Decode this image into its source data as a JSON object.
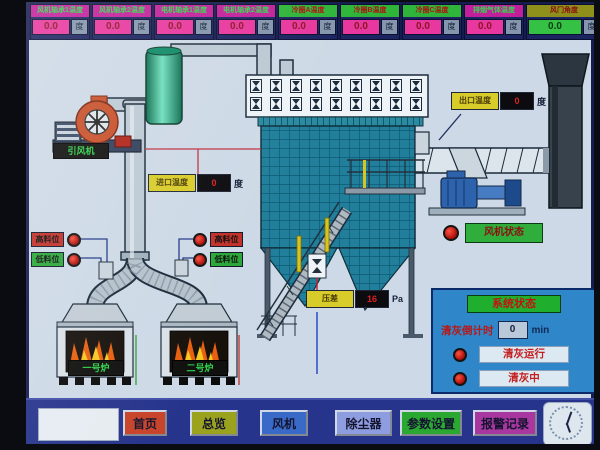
{
  "top_gauges": [
    {
      "label": "风机轴承1温度",
      "value": "0.0",
      "unit": "度",
      "style": "magenta"
    },
    {
      "label": "风机轴承2温度",
      "value": "0.0",
      "unit": "度",
      "style": "magenta"
    },
    {
      "label": "电机轴承1温度",
      "value": "0.0",
      "unit": "度",
      "style": "magenta"
    },
    {
      "label": "电机轴承2温度",
      "value": "0.0",
      "unit": "度",
      "style": "magenta"
    },
    {
      "label": "冷圈A温度",
      "value": "0.0",
      "unit": "度",
      "style": "green"
    },
    {
      "label": "冷圈B温度",
      "value": "0.0",
      "unit": "度",
      "style": "green"
    },
    {
      "label": "冷圈C温度",
      "value": "0.0",
      "unit": "度",
      "style": "green"
    },
    {
      "label": "排烟气体温度",
      "value": "0.0",
      "unit": "度",
      "style": "magenta"
    },
    {
      "label": "风门角度",
      "value": "0.0",
      "unit": "度",
      "style": "olive",
      "wide": true
    }
  ],
  "diagram": {
    "fan_label": "引风机",
    "inlet_temp": {
      "label": "进口温度",
      "value": "0",
      "unit": "度"
    },
    "outlet_temp": {
      "label": "出口温度",
      "value": "0",
      "unit": "度"
    },
    "pressure": {
      "label": "压差",
      "value": "16",
      "unit": "Pa"
    },
    "left_levels": [
      {
        "label": "高料位",
        "color": "#c23028"
      },
      {
        "label": "低料位",
        "color": "#2aa838"
      }
    ],
    "right_levels": [
      {
        "label": "高料位",
        "color": "#c23028"
      },
      {
        "label": "低料位",
        "color": "#2aa838"
      }
    ],
    "fan_status_label": "风机状态",
    "furnaces": [
      {
        "label": "一号炉"
      },
      {
        "label": "二号炉"
      }
    ],
    "pulse_valve_count": 18
  },
  "status_panel": {
    "title": "系统状态",
    "countdown_label": "清灰倒计时",
    "countdown_value": "0",
    "countdown_unit": "min",
    "indicators": [
      {
        "label": "清灰运行"
      },
      {
        "label": "清灰中"
      }
    ]
  },
  "nav": {
    "buttons": [
      {
        "label": "首页",
        "color": "#c8432a"
      },
      {
        "label": "总览",
        "color": "#9aa21e"
      },
      {
        "label": "风机",
        "color": "#3a6ac8"
      },
      {
        "label": "除尘器",
        "color": "#8e9de0"
      },
      {
        "label": "参数设置",
        "color": "#2aa832"
      },
      {
        "label": "报警记录",
        "color": "#a838a0"
      }
    ]
  },
  "colors": {
    "alarm_red": "#c42020",
    "ok_green": "#2aa838",
    "panel_blue": "#2f86c8"
  }
}
